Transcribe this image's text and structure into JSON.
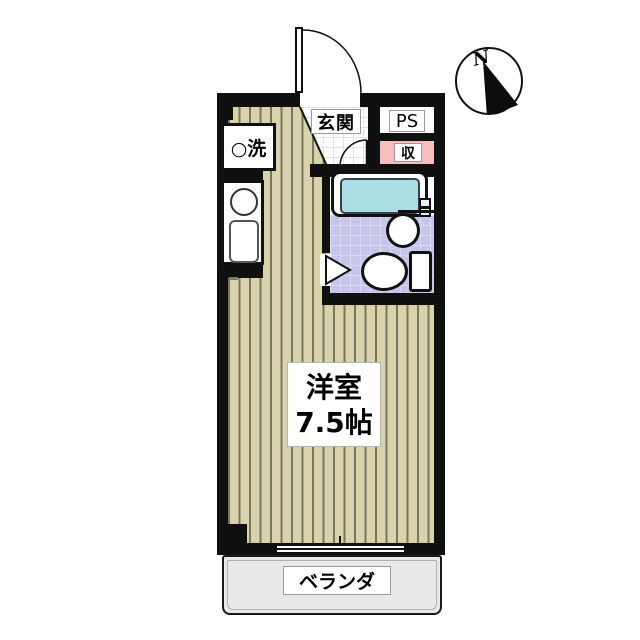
{
  "floor_plan": {
    "compass": {
      "north_label": "N"
    },
    "rooms": {
      "main_room": {
        "name": "洋室",
        "size": "7.5帖"
      },
      "entrance": {
        "label": "玄関"
      },
      "pipe_space": {
        "label": "PS"
      },
      "storage": {
        "label": "収"
      },
      "laundry": {
        "label": "○洗"
      },
      "veranda": {
        "label": "ベランダ"
      }
    },
    "colors": {
      "wall": "#101010",
      "tatami_floor": "#d9d3ac",
      "tatami_stripe": "#7b7660",
      "storage_fill": "#f6bdbd",
      "bath_water": "#abdde4",
      "bath_tile": "#c6c5ea",
      "veranda_fill": "#e9e9e9"
    }
  }
}
